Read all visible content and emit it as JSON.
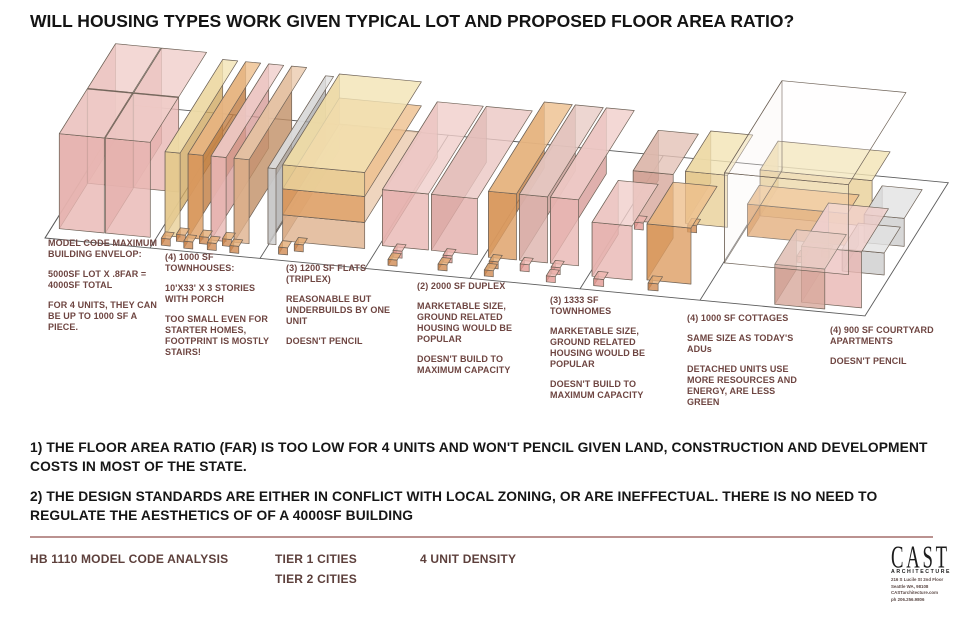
{
  "title": "WILL HOUSING TYPES WORK GIVEN TYPICAL LOT AND PROPOSED FLOOR AREA RATIO?",
  "conclusions": [
    "1) THE FLOOR AREA RATIO (FAR) IS TOO LOW FOR 4 UNITS AND WON'T PENCIL GIVEN LAND, CONSTRUCTION AND DEVELOPMENT COSTS IN MOST OF THE STATE.",
    "2) THE DESIGN STANDARDS ARE EITHER IN CONFLICT WITH LOCAL ZONING, OR ARE INEFFECTUAL. THERE IS NO NEED TO REGULATE THE AESTHETICS OF OF A 4000SF BUILDING"
  ],
  "footer": {
    "analysis_label": "HB 1110 MODEL CODE ANALYSIS",
    "tier1_label": "TIER 1 CITIES",
    "tier2_label": "TIER 2 CITIES",
    "density_label": "4 UNIT DENSITY"
  },
  "logo": {
    "name": "CAST",
    "sub": "ARCHITECTURE",
    "lines": [
      "216 S Lucile St 2nd Floor",
      "Seattle WA, 98108",
      "CASTarchitecture.com",
      "ph 206.256.9806"
    ]
  },
  "colors": {
    "annotation_text": "#6e4541",
    "footer_text": "#5d403c",
    "title_text": "#141414",
    "footer_rule": "#bb9290",
    "parcel_line": "#5c5c5c",
    "box_outline": "#6e6257"
  },
  "lots": [
    {
      "id": "max-envelope",
      "pos": [
        48,
        238,
        112
      ],
      "paragraphs": [
        "MODEL CODE MAXIMUM BUILDING ENVELOP:",
        "5000SF LOT X .8FAR = 4000SF TOTAL",
        "FOR 4 UNITS, THEY CAN BE UP TO 1000 SF A PIECE."
      ]
    },
    {
      "id": "townhouses-1000sf",
      "pos": [
        165,
        252,
        112
      ],
      "paragraphs": [
        "(4) 1000 SF TOWNHOUSES:",
        "10'X33' X 3 STORIES WITH PORCH",
        "TOO SMALL EVEN FOR STARTER HOMES, FOOTPRINT IS MOSTLY STAIRS!"
      ]
    },
    {
      "id": "flats-1200sf",
      "pos": [
        286,
        263,
        106
      ],
      "paragraphs": [
        "(3) 1200 SF FLATS (TRIPLEX)",
        "REASONABLE BUT UNDERBUILDS BY ONE UNIT",
        "DOESN'T PENCIL"
      ]
    },
    {
      "id": "duplex-2000sf",
      "pos": [
        417,
        281,
        112
      ],
      "paragraphs": [
        "(2) 2000 SF DUPLEX",
        "MARKETABLE SIZE, GROUND RELATED HOUSING WOULD BE POPULAR",
        "DOESN'T BUILD TO MAXIMUM CAPACITY"
      ]
    },
    {
      "id": "townhomes-1333sf",
      "pos": [
        550,
        295,
        112
      ],
      "paragraphs": [
        "(3) 1333 SF TOWNHOMES",
        "MARKETABLE SIZE, GROUND RELATED HOUSING WOULD BE POPULAR",
        "DOESN'T BUILD TO MAXIMUM CAPACITY"
      ]
    },
    {
      "id": "cottages-1000sf",
      "pos": [
        687,
        313,
        116
      ],
      "paragraphs": [
        "(4) 1000 SF COTTAGES",
        "SAME SIZE AS TODAY'S ADUs",
        "DETACHED UNITS USE MORE RESOURCES AND ENERGY, ARE LESS GREEN"
      ]
    },
    {
      "id": "courtyard-900sf",
      "pos": [
        830,
        325,
        108
      ],
      "paragraphs": [
        "(4) 900 SF COURTYARD APARTMENTS",
        "DOESN'T PENCIL"
      ]
    }
  ],
  "scene": {
    "origin": [
      45,
      238
    ],
    "u_slope": 0.095,
    "v_axis": [
      0.45,
      0.72
    ],
    "stroke": "#6e6257",
    "strip": {
      "u_max": 820,
      "depth": 185,
      "dividers": [
        0,
        105,
        215,
        320,
        425,
        535,
        655
      ],
      "line_color": "#5c5c5c"
    },
    "palette": {
      "pink": {
        "f": "#e8b7b3",
        "s": "#d79c98",
        "t": "#f0cecb"
      },
      "pinkd": {
        "f": "#e2aeaa",
        "s": "#bd928d",
        "t": "#ebc7c3"
      },
      "pinkc": {
        "f": "#e39a93",
        "s": "#c87d76",
        "t": "#eeb5af"
      },
      "mauve": {
        "f": "#d7a89b",
        "s": "#bc897c",
        "t": "#e4c2b7"
      },
      "mauvepale": {
        "f": "#ddb3ad",
        "s": "#c4968f",
        "t": "#e9ccc6"
      },
      "tan": {
        "f": "#e8cf97",
        "s": "#cfa963",
        "t": "#f2e3b4"
      },
      "orange": {
        "f": "#dd9d63",
        "s": "#c17c40",
        "t": "#edbf8d"
      },
      "peach": {
        "f": "#dfb18d",
        "s": "#c18e65",
        "t": "#ebcaae"
      },
      "gray": {
        "f": "#cdcdcd",
        "s": "#adadad",
        "t": "#e2e2e2"
      },
      "porch": {
        "f": "#d18b52",
        "s": "#b06c36",
        "t": "#e3ab74"
      },
      "ghost": {
        "f": "#ffffff",
        "s": "#f4f1ea",
        "t": "#fdfcf7"
      }
    },
    "boxes": [
      {
        "lot": "max-envelope",
        "u": 8,
        "v": 77,
        "w": 45,
        "d": 62,
        "h": 95,
        "c": "pink"
      },
      {
        "lot": "max-envelope",
        "u": 54,
        "v": 77,
        "w": 45,
        "d": 62,
        "h": 95,
        "c": "pink"
      },
      {
        "lot": "max-envelope",
        "u": 8,
        "v": 14,
        "w": 45,
        "d": 62,
        "h": 95,
        "c": "pink"
      },
      {
        "lot": "max-envelope",
        "u": 54,
        "v": 14,
        "w": 45,
        "d": 62,
        "h": 95,
        "c": "pink"
      },
      {
        "lot": "townhouses-1000sf",
        "u": 112,
        "v": 18,
        "w": 15,
        "d": 128,
        "h": 84,
        "c": "tan"
      },
      {
        "lot": "townhouses-1000sf",
        "u": 135,
        "v": 18,
        "w": 15,
        "d": 128,
        "h": 84,
        "c": "orange"
      },
      {
        "lot": "townhouses-1000sf",
        "u": 158,
        "v": 18,
        "w": 15,
        "d": 128,
        "h": 84,
        "c": "pink"
      },
      {
        "lot": "townhouses-1000sf",
        "u": 181,
        "v": 18,
        "w": 15,
        "d": 128,
        "h": 84,
        "c": "peach"
      },
      {
        "lot": "townhouses-1000sf",
        "u": 126,
        "v": 12,
        "w": 9,
        "d": 9,
        "h": 7,
        "c": "porch"
      },
      {
        "lot": "townhouses-1000sf",
        "u": 149,
        "v": 12,
        "w": 9,
        "d": 9,
        "h": 7,
        "c": "porch"
      },
      {
        "lot": "townhouses-1000sf",
        "u": 172,
        "v": 12,
        "w": 9,
        "d": 9,
        "h": 7,
        "c": "porch"
      },
      {
        "lot": "townhouses-1000sf",
        "u": 114,
        "v": 5,
        "w": 9,
        "d": 9,
        "h": 7,
        "c": "porch"
      },
      {
        "lot": "townhouses-1000sf",
        "u": 137,
        "v": 4,
        "w": 9,
        "d": 9,
        "h": 7,
        "c": "porch"
      },
      {
        "lot": "townhouses-1000sf",
        "u": 160,
        "v": 5,
        "w": 9,
        "d": 9,
        "h": 7,
        "c": "porch"
      },
      {
        "lot": "townhouses-1000sf",
        "u": 183,
        "v": 4,
        "w": 9,
        "d": 9,
        "h": 7,
        "c": "porch"
      },
      {
        "lot": "flats-1200sf",
        "u": 214,
        "v": 20,
        "w": 8,
        "d": 128,
        "h": 76,
        "c": "gray"
      },
      {
        "lot": "flats-1200sf",
        "u": 226,
        "v": 26,
        "w": 82,
        "d": 126,
        "h": 26,
        "c": "peach"
      },
      {
        "lot": "flats-1200sf",
        "u": 226,
        "v": 26,
        "w": 82,
        "d": 126,
        "h": 26,
        "z": 26,
        "c": "orange"
      },
      {
        "lot": "flats-1200sf",
        "u": 226,
        "v": 26,
        "w": 82,
        "d": 126,
        "h": 24,
        "z": 52,
        "c": "tan"
      },
      {
        "lot": "flats-1200sf",
        "u": 230,
        "v": 8,
        "w": 9,
        "d": 9,
        "h": 7,
        "c": "porch"
      },
      {
        "lot": "flats-1200sf",
        "u": 243,
        "v": 14,
        "w": 9,
        "d": 9,
        "h": 7,
        "c": "porch"
      },
      {
        "lot": "duplex-2000sf",
        "u": 323,
        "v": 32,
        "w": 46,
        "d": 122,
        "h": 56,
        "c": "pink"
      },
      {
        "lot": "duplex-2000sf",
        "u": 372,
        "v": 32,
        "w": 46,
        "d": 122,
        "h": 56,
        "c": "pinkd"
      },
      {
        "lot": "duplex-2000sf",
        "u": 340,
        "v": 18,
        "w": 9,
        "d": 9,
        "h": 7,
        "c": "pinkc"
      },
      {
        "lot": "duplex-2000sf",
        "u": 340,
        "v": 7,
        "w": 9,
        "d": 9,
        "h": 6,
        "c": "porch"
      },
      {
        "lot": "duplex-2000sf",
        "u": 390,
        "v": 18,
        "w": 9,
        "d": 9,
        "h": 7,
        "c": "pinkc"
      },
      {
        "lot": "duplex-2000sf",
        "u": 390,
        "v": 7,
        "w": 9,
        "d": 9,
        "h": 6,
        "c": "porch"
      },
      {
        "lot": "townhomes-1333sf",
        "u": 430,
        "v": 30,
        "w": 28,
        "d": 124,
        "h": 66,
        "c": "orange"
      },
      {
        "lot": "townhomes-1333sf",
        "u": 461,
        "v": 30,
        "w": 28,
        "d": 124,
        "h": 66,
        "c": "mauvepale"
      },
      {
        "lot": "townhomes-1333sf",
        "u": 492,
        "v": 30,
        "w": 28,
        "d": 124,
        "h": 66,
        "c": "pink"
      },
      {
        "lot": "townhomes-1333sf",
        "u": 437,
        "v": 16,
        "w": 9,
        "d": 9,
        "h": 7,
        "c": "porch"
      },
      {
        "lot": "townhomes-1333sf",
        "u": 468,
        "v": 16,
        "w": 9,
        "d": 9,
        "h": 7,
        "c": "pinkc"
      },
      {
        "lot": "townhomes-1333sf",
        "u": 499,
        "v": 16,
        "w": 9,
        "d": 9,
        "h": 7,
        "c": "pinkc"
      },
      {
        "lot": "townhomes-1333sf",
        "u": 437,
        "v": 5,
        "w": 9,
        "d": 9,
        "h": 6,
        "c": "porch"
      },
      {
        "lot": "townhomes-1333sf",
        "u": 499,
        "v": 5,
        "w": 9,
        "d": 9,
        "h": 6,
        "c": "pinkc"
      },
      {
        "lot": "cottages-1000sf",
        "u": 545,
        "v": 96,
        "w": 40,
        "d": 56,
        "h": 50,
        "c": "mauve"
      },
      {
        "lot": "cottages-1000sf",
        "u": 596,
        "v": 99,
        "w": 42,
        "d": 56,
        "h": 52,
        "c": "tan"
      },
      {
        "lot": "cottages-1000sf",
        "u": 551,
        "v": 85,
        "w": 9,
        "d": 9,
        "h": 7,
        "c": "pinkc"
      },
      {
        "lot": "cottages-1000sf",
        "u": 603,
        "v": 88,
        "w": 9,
        "d": 9,
        "h": 7,
        "c": "porch"
      },
      {
        "lot": "cottages-1000sf",
        "u": 539,
        "v": 18,
        "w": 40,
        "d": 58,
        "h": 54,
        "c": "pink"
      },
      {
        "lot": "cottages-1000sf",
        "u": 593,
        "v": 20,
        "w": 44,
        "d": 58,
        "h": 56,
        "c": "orange"
      },
      {
        "lot": "cottages-1000sf",
        "u": 546,
        "v": 6,
        "w": 10,
        "d": 10,
        "h": 7,
        "c": "pinkc"
      },
      {
        "lot": "cottages-1000sf",
        "u": 600,
        "v": 7,
        "w": 10,
        "d": 10,
        "h": 7,
        "c": "porch"
      },
      {
        "lot": "courtyard-900sf",
        "u": 662,
        "v": 118,
        "w": 112,
        "d": 40,
        "h": 46,
        "c": "tan"
      },
      {
        "lot": "courtyard-900sf",
        "u": 662,
        "v": 90,
        "w": 100,
        "d": 26,
        "h": 32,
        "c": "orange"
      },
      {
        "lot": "courtyard-900sf",
        "u": 776,
        "v": 96,
        "w": 40,
        "d": 40,
        "h": 28,
        "c": "gray"
      },
      {
        "lot": "courtyard-900sf",
        "u": 772,
        "v": 56,
        "w": 42,
        "d": 36,
        "h": 22,
        "c": "gray"
      },
      {
        "lot": "courtyard-900sf",
        "u": 744,
        "v": 72,
        "w": 8,
        "d": 8,
        "h": 6,
        "c": "pinkc"
      },
      {
        "lot": "courtyard-900sf",
        "u": 724,
        "v": 62,
        "w": 8,
        "d": 8,
        "h": 6,
        "c": "pinkc"
      },
      {
        "lot": "courtyard-900sf",
        "u": 752,
        "v": 10,
        "w": 60,
        "d": 60,
        "h": 56,
        "c": "pink"
      },
      {
        "lot": "courtyard-900sf",
        "u": 728,
        "v": 4,
        "w": 50,
        "d": 48,
        "h": 40,
        "c": "mauve"
      },
      {
        "lot": "courtyard-900sf",
        "u": 656,
        "v": 52,
        "w": 124,
        "d": 128,
        "h": 90,
        "c": "ghost",
        "o": 0.18
      }
    ]
  }
}
